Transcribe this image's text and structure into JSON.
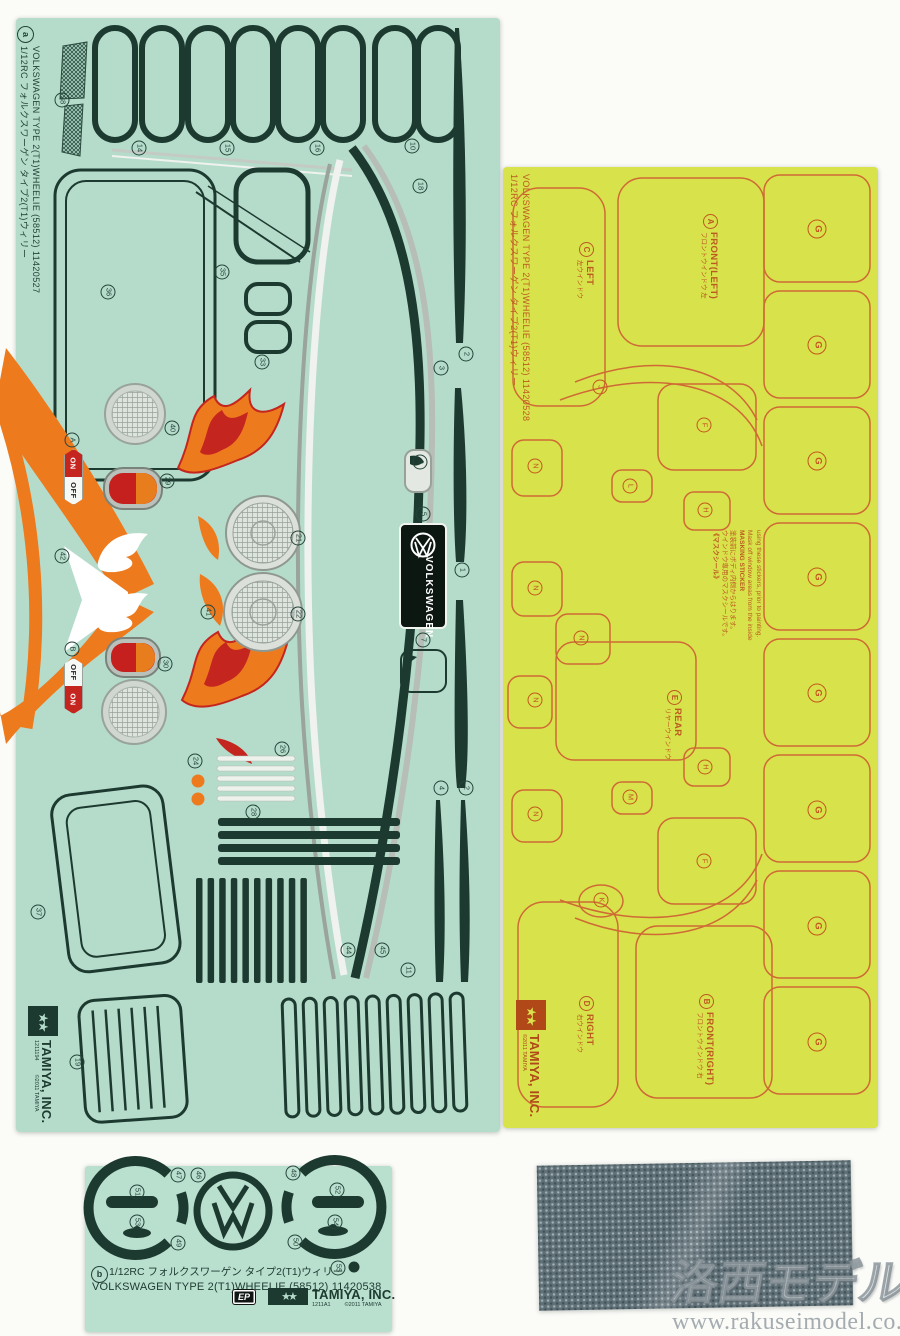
{
  "page": {
    "background": "#fbfbf8"
  },
  "watermark": {
    "brand": "洛西モデル",
    "url": "www.rakuseimodel.co.jp"
  },
  "sheet_a": {
    "badge": "a",
    "caption_en": "VOLKSWAGEN TYPE 2(T1)WHEELIE (58512) 11420527",
    "caption_jp": "1/12RC フォルクスワーゲン タイプ2(T1)ウィリー",
    "vw_label": "VOLKSWAGEN",
    "switch_a": {
      "top": "ON",
      "bottom": "OFF"
    },
    "switch_b": {
      "top": "OFF",
      "bottom": "ON"
    },
    "tamiya": {
      "name": "TAMIYA, INC.",
      "code": "1211194",
      "copyright": "©2011 TAMIYA"
    },
    "colors": {
      "sheet": "#b5dccb",
      "decal_dark": "#1d3a30",
      "orange": "#ee7a1e",
      "red": "#c4251f",
      "silver": "#b7bdb7"
    },
    "markers": [
      {
        "t": "38",
        "x": 62,
        "y": 100
      },
      {
        "t": "14",
        "x": 139,
        "y": 148
      },
      {
        "t": "15",
        "x": 227,
        "y": 148
      },
      {
        "t": "16",
        "x": 317,
        "y": 148
      },
      {
        "t": "10",
        "x": 412,
        "y": 146
      },
      {
        "t": "18",
        "x": 420,
        "y": 186
      },
      {
        "t": "35",
        "x": 222,
        "y": 272
      },
      {
        "t": "36",
        "x": 108,
        "y": 292
      },
      {
        "t": "33",
        "x": 262,
        "y": 362
      },
      {
        "t": "2",
        "x": 466,
        "y": 354
      },
      {
        "t": "3",
        "x": 441,
        "y": 368
      },
      {
        "t": "40",
        "x": 172,
        "y": 428
      },
      {
        "t": "A",
        "x": 72,
        "y": 440
      },
      {
        "t": "6",
        "x": 420,
        "y": 462
      },
      {
        "t": "29",
        "x": 167,
        "y": 481
      },
      {
        "t": "5",
        "x": 423,
        "y": 514
      },
      {
        "t": "21",
        "x": 298,
        "y": 538
      },
      {
        "t": "42",
        "x": 62,
        "y": 556
      },
      {
        "t": "1",
        "x": 462,
        "y": 570
      },
      {
        "t": "41",
        "x": 208,
        "y": 612
      },
      {
        "t": "22",
        "x": 298,
        "y": 614
      },
      {
        "t": "7",
        "x": 423,
        "y": 640
      },
      {
        "t": "B",
        "x": 72,
        "y": 649
      },
      {
        "t": "30",
        "x": 165,
        "y": 664
      },
      {
        "t": "26",
        "x": 282,
        "y": 749
      },
      {
        "t": "24",
        "x": 195,
        "y": 761
      },
      {
        "t": "4",
        "x": 441,
        "y": 788
      },
      {
        "t": "2",
        "x": 466,
        "y": 788
      },
      {
        "t": "28",
        "x": 253,
        "y": 812
      },
      {
        "t": "37",
        "x": 38,
        "y": 912
      },
      {
        "t": "44",
        "x": 348,
        "y": 950
      },
      {
        "t": "45",
        "x": 382,
        "y": 950
      },
      {
        "t": "11",
        "x": 408,
        "y": 970
      },
      {
        "t": "19",
        "x": 77,
        "y": 1062
      }
    ]
  },
  "sheet_mask": {
    "caption_en": "VOLKSWAGEN TYPE 2(T1)WHEELIE (58512) 11420528",
    "caption_jp": "1/12RC フォルクスワーゲン タイプ2(T1)ウィリー",
    "labels": [
      {
        "letter": "A",
        "en": "FRONT(LEFT)",
        "jp": "フロントウインドウ 左"
      },
      {
        "letter": "C",
        "en": "LEFT",
        "jp": "左ウインドウ"
      },
      {
        "letter": "E",
        "en": "REAR",
        "jp": "リヤーウインドウ"
      },
      {
        "letter": "D",
        "en": "RIGHT",
        "jp": "右ウインドウ"
      },
      {
        "letter": "B",
        "en": "FRONT(RIGHT)",
        "jp": "フロントウインドウ 右"
      }
    ],
    "note": {
      "jp_title": "《マスクシール》",
      "jp_line1": "ウインドウ専用のマスクシールです。",
      "jp_line2": "塗装前にボディ内側からはります。",
      "en_title": "MASKING STICKER",
      "en_line1": "Mask off window areas from the inside",
      "en_line2": "using these stickers, prior to painting."
    },
    "tamiya": {
      "name": "TAMIYA, INC.",
      "copyright": "©2011 TAMIYA"
    },
    "colors": {
      "sheet": "#d8e24b",
      "line": "#cf6a35",
      "text": "#bc5a20"
    },
    "markers": [
      {
        "t": "J",
        "x": 600,
        "y": 387
      },
      {
        "t": "F",
        "x": 704,
        "y": 425
      },
      {
        "t": "N",
        "x": 535,
        "y": 466
      },
      {
        "t": "L",
        "x": 630,
        "y": 486
      },
      {
        "t": "H",
        "x": 705,
        "y": 510
      },
      {
        "t": "N",
        "x": 535,
        "y": 588
      },
      {
        "t": "N",
        "x": 581,
        "y": 638
      },
      {
        "t": "N",
        "x": 535,
        "y": 700
      },
      {
        "t": "H",
        "x": 705,
        "y": 767
      },
      {
        "t": "M",
        "x": 630,
        "y": 797
      },
      {
        "t": "N",
        "x": 535,
        "y": 814
      },
      {
        "t": "F",
        "x": 704,
        "y": 861
      },
      {
        "t": "K",
        "x": 601,
        "y": 900
      },
      {
        "t": "G",
        "x": 817,
        "y": 229
      },
      {
        "t": "G",
        "x": 817,
        "y": 345
      },
      {
        "t": "G",
        "x": 817,
        "y": 461
      },
      {
        "t": "G",
        "x": 817,
        "y": 577
      },
      {
        "t": "G",
        "x": 817,
        "y": 693
      },
      {
        "t": "G",
        "x": 817,
        "y": 810
      },
      {
        "t": "G",
        "x": 817,
        "y": 926
      },
      {
        "t": "G",
        "x": 817,
        "y": 1042
      }
    ]
  },
  "sheet_b": {
    "badge": "b",
    "caption_jp": "1/12RC フォルクスワーゲン タイプ2(T1)ウィリー",
    "caption_en": "VOLKSWAGEN TYPE 2(T1)WHEELIE (58512) 11420538",
    "ep_badge": "EP",
    "tamiya": {
      "name": "TAMIYA, INC.",
      "code": "1211A1",
      "copyright": "©2011 TAMIYA"
    },
    "markers": [
      {
        "t": "47",
        "x": 178,
        "y": 1175
      },
      {
        "t": "46",
        "x": 198,
        "y": 1175
      },
      {
        "t": "48",
        "x": 293,
        "y": 1173
      },
      {
        "t": "51",
        "x": 137,
        "y": 1192
      },
      {
        "t": "52",
        "x": 337,
        "y": 1190
      },
      {
        "t": "53",
        "x": 137,
        "y": 1222
      },
      {
        "t": "54",
        "x": 335,
        "y": 1222
      },
      {
        "t": "49",
        "x": 178,
        "y": 1243
      },
      {
        "t": "50",
        "x": 295,
        "y": 1242
      },
      {
        "t": "55",
        "x": 338,
        "y": 1268
      }
    ]
  }
}
